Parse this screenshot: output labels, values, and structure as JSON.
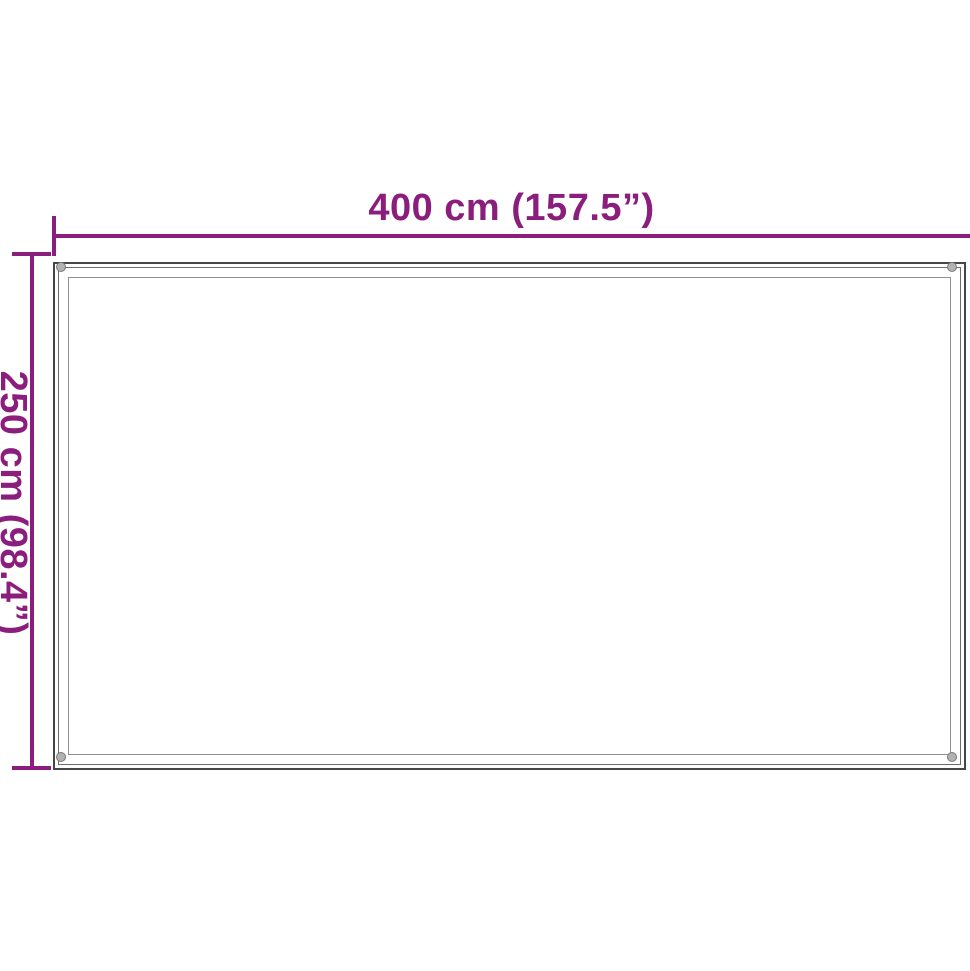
{
  "diagram": {
    "type": "product-dimension-diagram",
    "shape": "rectangle with corner grommets",
    "width_label": "400 cm (157.5”)",
    "height_label": "250 cm (98.4”)"
  },
  "colors": {
    "dimension": "#8b1e7d",
    "outline": "#474747",
    "outline_secondary": "#6b6b6b",
    "hem": "#919191",
    "eyelet": "#b2b2b2",
    "background": "#ffffff"
  }
}
